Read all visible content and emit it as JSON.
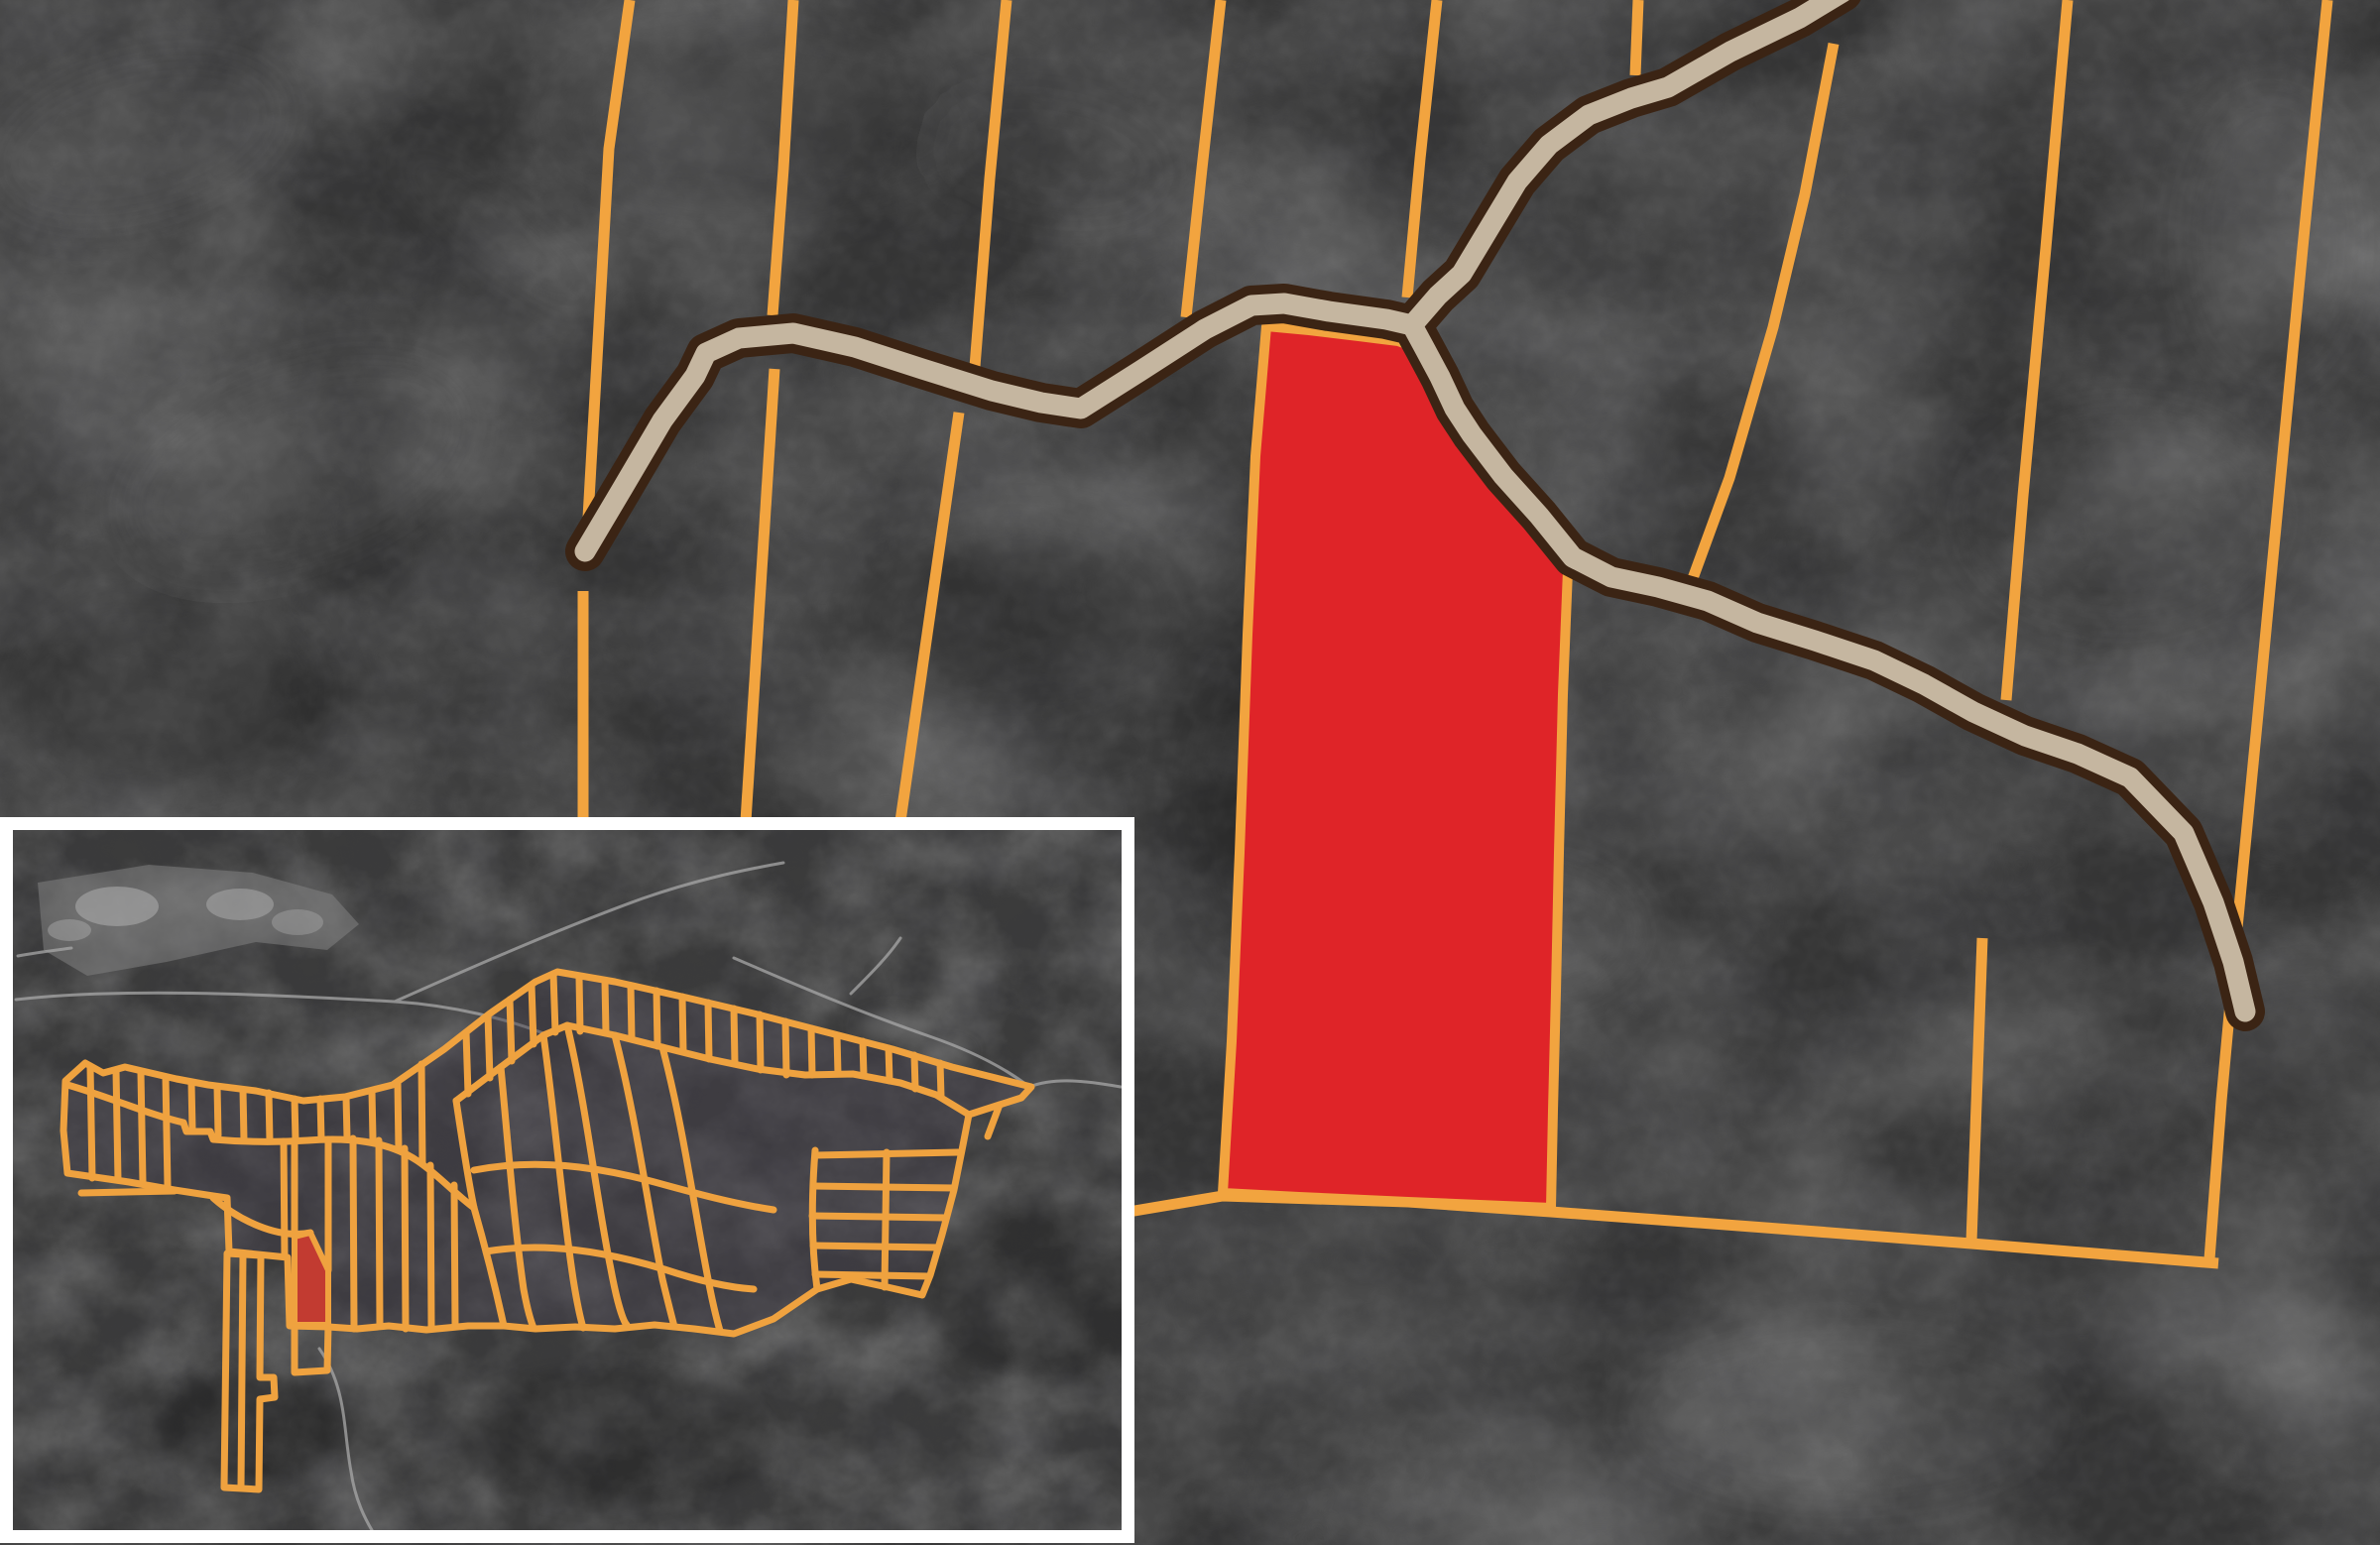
{
  "app": {
    "type": "gis-parcel-map-viewer",
    "base_layer": "satellite-grayscale",
    "description": "Parcel boundary map with one selected lot highlighted and an overview locator inset"
  },
  "colors": {
    "map_background": "#353535",
    "parcel_line": "#F2A43F",
    "selected_parcel_fill": "#DF2428",
    "road_casing": "#3B2414",
    "road_fill": "#C5B6A0",
    "inset_background": "#3B3B3B",
    "inset_parcel_line": "#EFA23F",
    "inset_selected_fill": "#C23B31",
    "inset_cluster_tint": "#423D4B",
    "inset_border": "#FFFFFF",
    "field_patch": "#858585",
    "minor_road": "#A8A8A8",
    "texture_light": "#8E8E8E",
    "texture_dark": "#101010"
  },
  "features": {
    "selected_parcel": {
      "name": "selected-parcel",
      "state": "highlighted"
    },
    "road": {
      "name": "access-road",
      "style": "tan-with-dark-casing",
      "endpoints": "rounded"
    },
    "parcel_grid": {
      "name": "parcel-boundaries",
      "style": "orange-lines"
    },
    "inset": {
      "name": "overview-inset",
      "role": "locator-map",
      "position": "bottom-left",
      "highlight": "selected-parcel-location"
    }
  }
}
